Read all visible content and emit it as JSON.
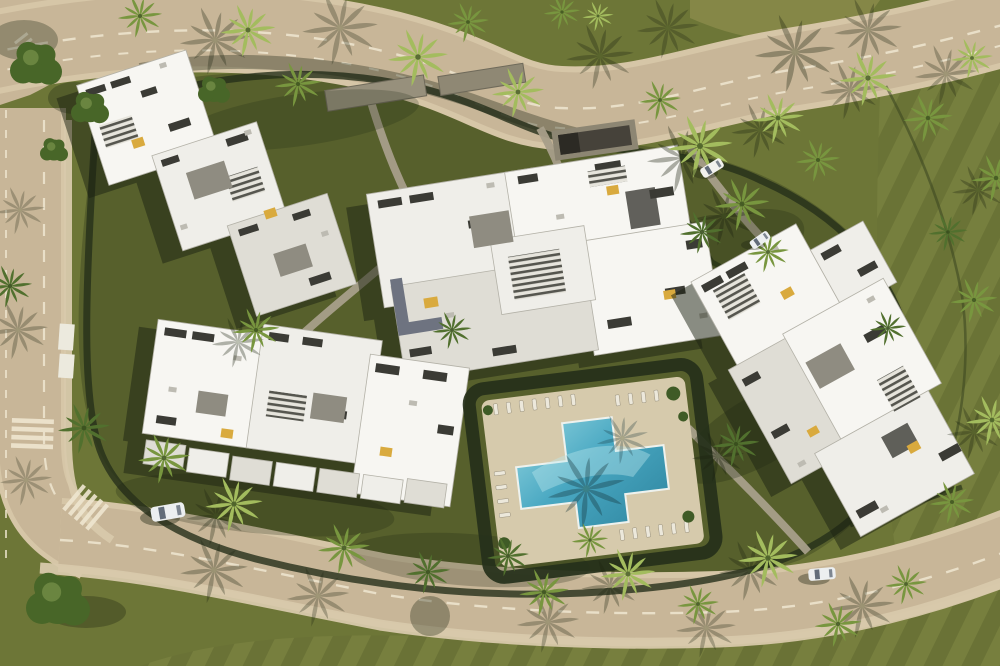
{
  "scene": {
    "title": "Aerial drone view render of a white modern apartment complex with gardens, palm trees, roads and a cross-shaped swimming pool",
    "type": "architectural-aerial-render",
    "objects": {
      "building_clusters": 4,
      "swimming_pools": 1,
      "pool_shape": "stepped cross",
      "vehicles_visible": 4,
      "crosswalks": 2,
      "palm_trees_approx": 40,
      "sun_loungers_rows": 5
    },
    "palette": {
      "grass-base": "#6d7637",
      "grass-dark": "#57602c",
      "grass-light": "#878a49",
      "verge": "#767c3c",
      "mow-a": "#78803f",
      "mow-b": "#6a7236",
      "road": "#c8b698",
      "road-edge": "#d6c6a7",
      "sidewalk": "#d8c9ab",
      "marking": "#efe6d0",
      "hedge": "#25301a",
      "path": "#a89f8a",
      "roof-white": "#efeee9",
      "roof-light": "#f7f6f2",
      "roof-mid": "#dfddd5",
      "roof-dark": "#bdbbb2",
      "roof-edge": "#b3b1a7",
      "glazing": "#3b3b35",
      "court": "#8f8c81",
      "wall-gray": "#6e7380",
      "slat-dark": "#3d3d36",
      "accent-yellow": "#d9aa3e",
      "deck": "#d6caac",
      "lounger": "#ece8db",
      "pool-deep": "#2f86a0",
      "pool-mid": "#49a8c2",
      "pool-light": "#8fd2de",
      "palm-light": "#a3bc5e",
      "palm-mid": "#78963f",
      "palm-dark": "#51702e",
      "leafy": "#486628",
      "shadow": "rgba(28,33,18,0.5)",
      "cast": "#1c2310",
      "car-white": "#eceff0",
      "van-white": "#f2f2ee",
      "glass": "#626c79"
    }
  }
}
